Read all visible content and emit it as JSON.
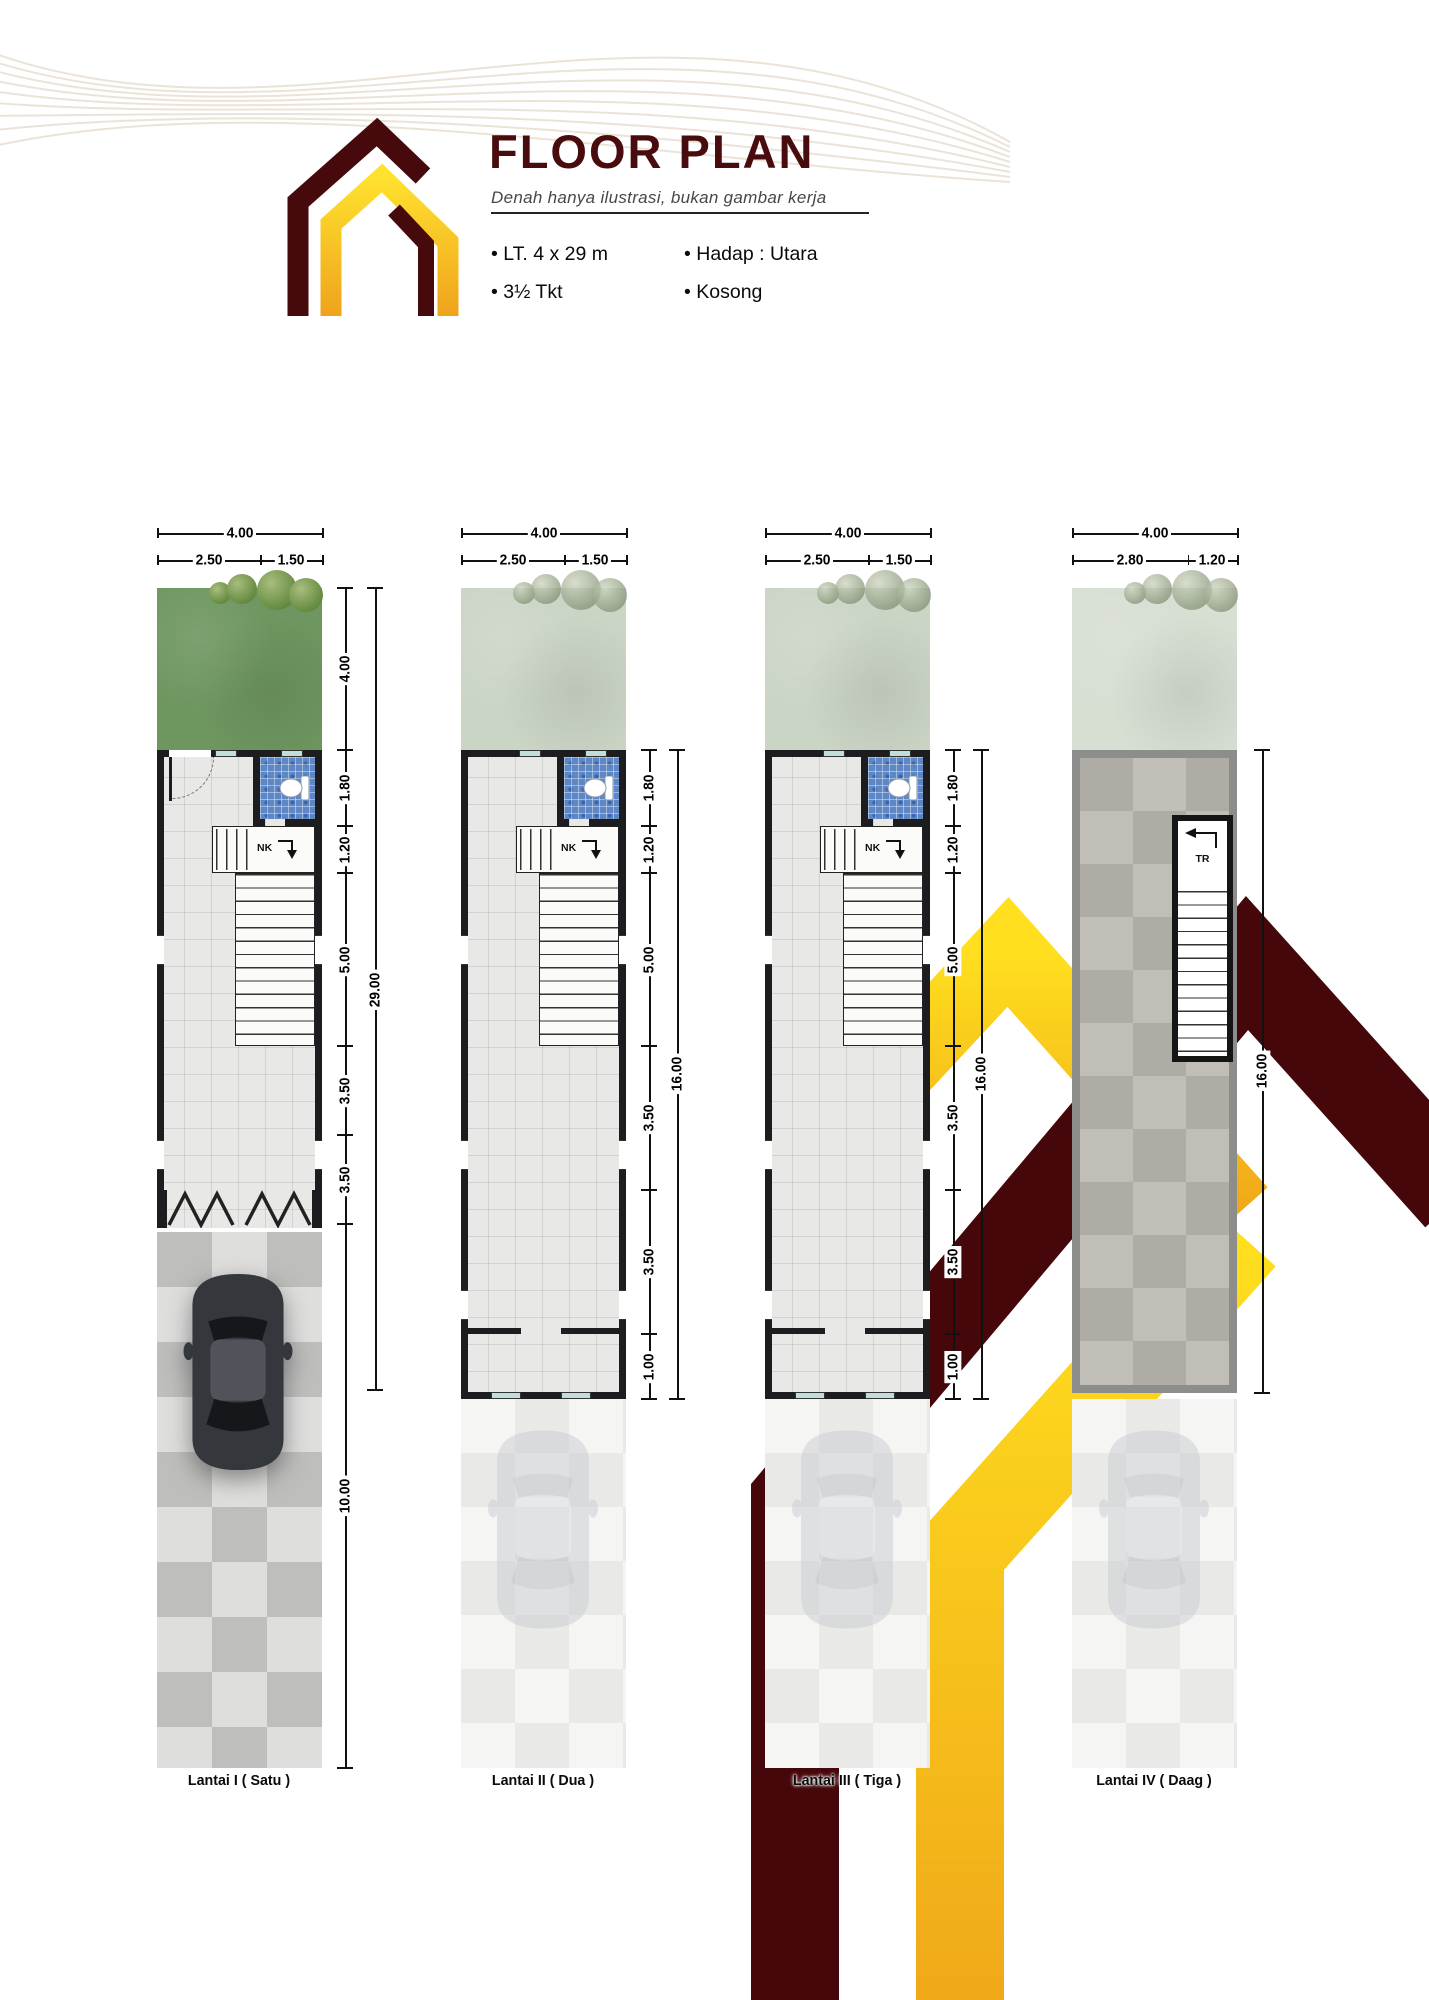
{
  "header": {
    "title": "FLOOR PLAN",
    "subtitle": "Denah hanya ilustrasi, bukan gambar kerja",
    "specs": [
      {
        "text": "LT. 4 x 29 m"
      },
      {
        "text": "3½ Tkt"
      },
      {
        "text": "Hadap : Utara"
      },
      {
        "text": "Kosong"
      }
    ]
  },
  "colors": {
    "maroon": "#45070A",
    "gold_light": "#FFDF1E",
    "gold_dark": "#F0A819",
    "title_text": "#480c0e",
    "bathroom_tile": "#5d87c5",
    "garden_green": "#6e9660",
    "garden_faded": "#c9d6c3"
  },
  "plans": [
    {
      "name": "Lantai I ( Satu )",
      "top_dims": {
        "total": "4.00",
        "a": "2.50",
        "b": "1.50"
      },
      "side_dims": [
        "4.00",
        "1.80",
        "1.20",
        "5.00",
        "3.50",
        "3.50",
        "10.00"
      ],
      "overall_dim": "29.00",
      "stair_label": "NK"
    },
    {
      "name": "Lantai II ( Dua )",
      "top_dims": {
        "total": "4.00",
        "a": "2.50",
        "b": "1.50"
      },
      "side_dims": [
        "1.80",
        "1.20",
        "5.00",
        "3.50",
        "3.50",
        "1.00"
      ],
      "overall_dim": "16.00",
      "stair_label": "NK"
    },
    {
      "name": "Lantai III ( Tiga )",
      "top_dims": {
        "total": "4.00",
        "a": "2.50",
        "b": "1.50"
      },
      "side_dims": [
        "1.80",
        "1.20",
        "5.00",
        "3.50",
        "3.50",
        "1.00"
      ],
      "overall_dim": "16.00",
      "stair_label": "NK"
    },
    {
      "name": "Lantai IV ( Daag )",
      "top_dims": {
        "total": "4.00",
        "a": "2.80",
        "b": "1.20"
      },
      "side_dims": [],
      "overall_dim": "16.00",
      "stair_label": "TR"
    }
  ]
}
